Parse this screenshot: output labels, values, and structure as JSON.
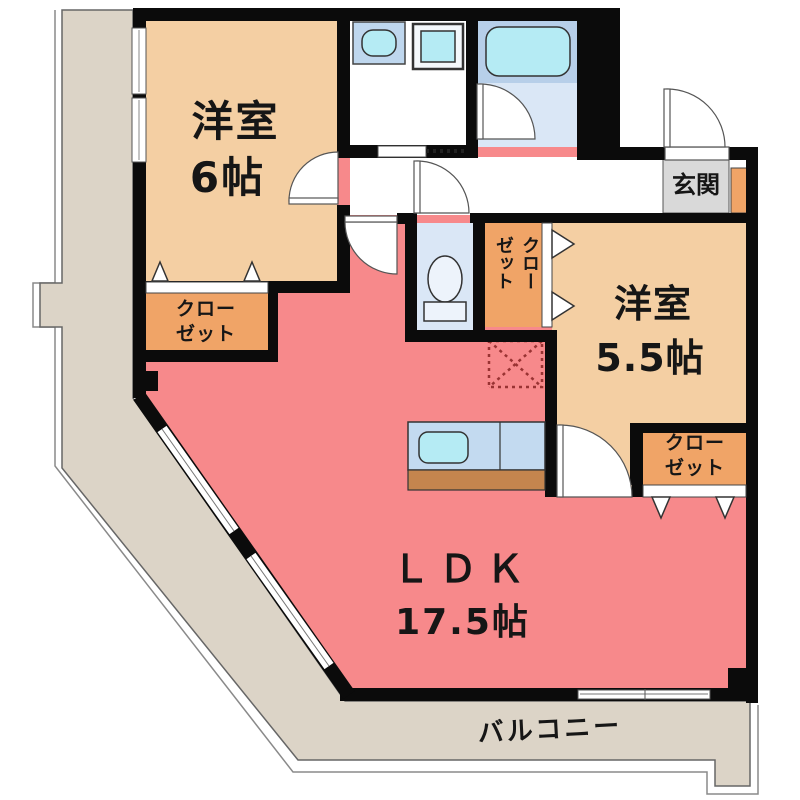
{
  "rooms": {
    "bedroom_6": {
      "name": "洋室",
      "size": "6帖"
    },
    "bedroom_5_5": {
      "name": "洋室",
      "size": "5.5帖"
    },
    "ldk": {
      "name": "ＬＤＫ",
      "size": "17.5帖"
    },
    "entrance": {
      "label": "玄関"
    },
    "balcony": {
      "label": "バルコニー"
    }
  },
  "closets": {
    "bedroom6_closet": {
      "lines": [
        "クロー",
        "ゼット"
      ]
    },
    "bedroom55_closet": {
      "lines": [
        "クロー",
        "ゼット"
      ]
    },
    "hall_closet": {
      "label": "クローゼット"
    }
  },
  "fixtures": [
    "bathtub",
    "vanity-sink",
    "washing-machine",
    "toilet",
    "kitchen-counter",
    "kitchen-sink",
    "refrigerator-space"
  ],
  "colors": {
    "wall": "#0b0b0b",
    "ldk_pink": "#F7898B",
    "bedroom_beige": "#F4CFA3",
    "closet_orange": "#F0A467",
    "balcony_gray": "#DCD4C7",
    "entrance_gray": "#D9D9D9",
    "wet_floor_blue": "#DAE7F6",
    "bath_band_blue": "#B7CFE9",
    "fixture_cyan": "#B5EBF4",
    "counter_blue": "#C3DAF0",
    "counter_wood": "#C4854E",
    "fridge_dash_red": "#993333"
  }
}
